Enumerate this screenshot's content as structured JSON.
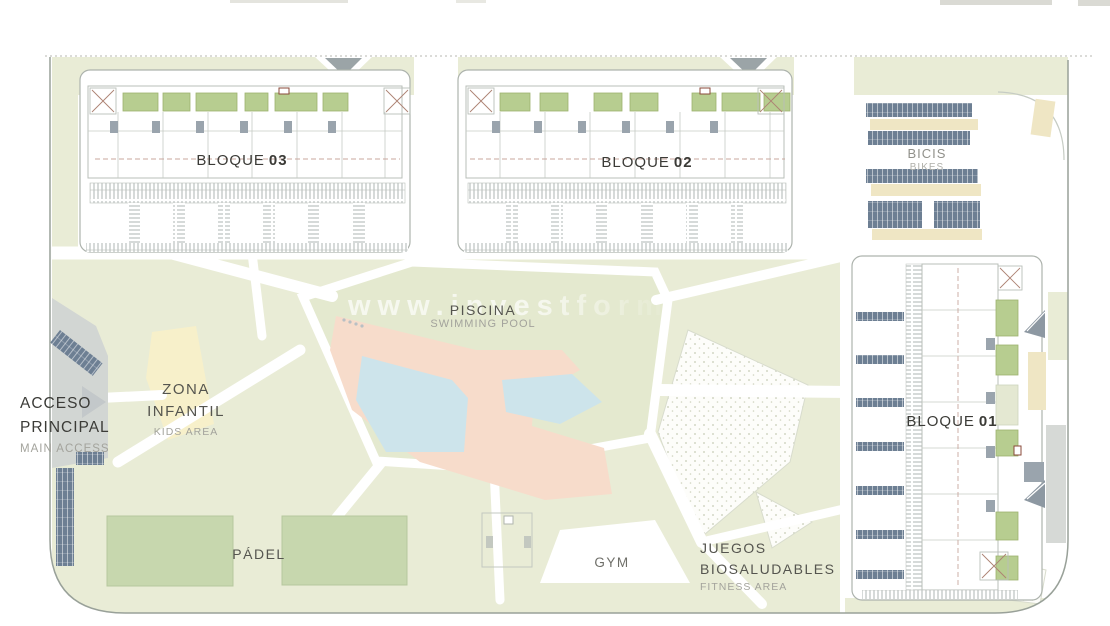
{
  "site": {
    "type": "residential development site plan"
  },
  "watermark": {
    "text": "www.investforma"
  },
  "blocks": [
    {
      "label": "BLOQUE",
      "number": "03"
    },
    {
      "label": "BLOQUE",
      "number": "02"
    },
    {
      "label": "BLOQUE",
      "number": "01"
    }
  ],
  "areas": {
    "pool": {
      "es": "PISCINA",
      "en": "SWIMMING POOL"
    },
    "kids": {
      "es1": "ZONA",
      "es2": "INFANTIL",
      "en": "KIDS AREA"
    },
    "access": {
      "es1": "ACCESO",
      "es2": "PRINCIPAL",
      "en": "MAIN ACCESS"
    },
    "padel": {
      "es": "PÁDEL"
    },
    "gym": {
      "label": "GYM"
    },
    "fitness": {
      "es1": "JUEGOS",
      "es2": "BIOSALUDABLES",
      "en": "FITNESS AREA"
    },
    "bikes": {
      "es": "BICIS",
      "en": "BIKES"
    }
  },
  "colors": {
    "landscape_green": "#e9ecd6",
    "pool_lawn": "#e4e9cf",
    "terrace_green": "#b7cd90",
    "terrace_edge": "#9db36f",
    "padel_green": "#c7d7ae",
    "pool_deck_pink": "#f7dccb",
    "pool_water_blue": "#cde4eb",
    "kids_yellow": "#f7f0ca",
    "bike_rack_slate": "#6d7f93",
    "parking_tan": "#efe6c4",
    "road_gray": "#d2d6d3",
    "arrow_gray": "#9ba4a7",
    "detail_gray": "#9aa4ad",
    "outline_gray": "#adb3ad",
    "boundary_gray": "#99a199",
    "text_dark": "#3b3b37",
    "text_gray": "#a3a39c",
    "dash_warm": "#c9a79e"
  }
}
